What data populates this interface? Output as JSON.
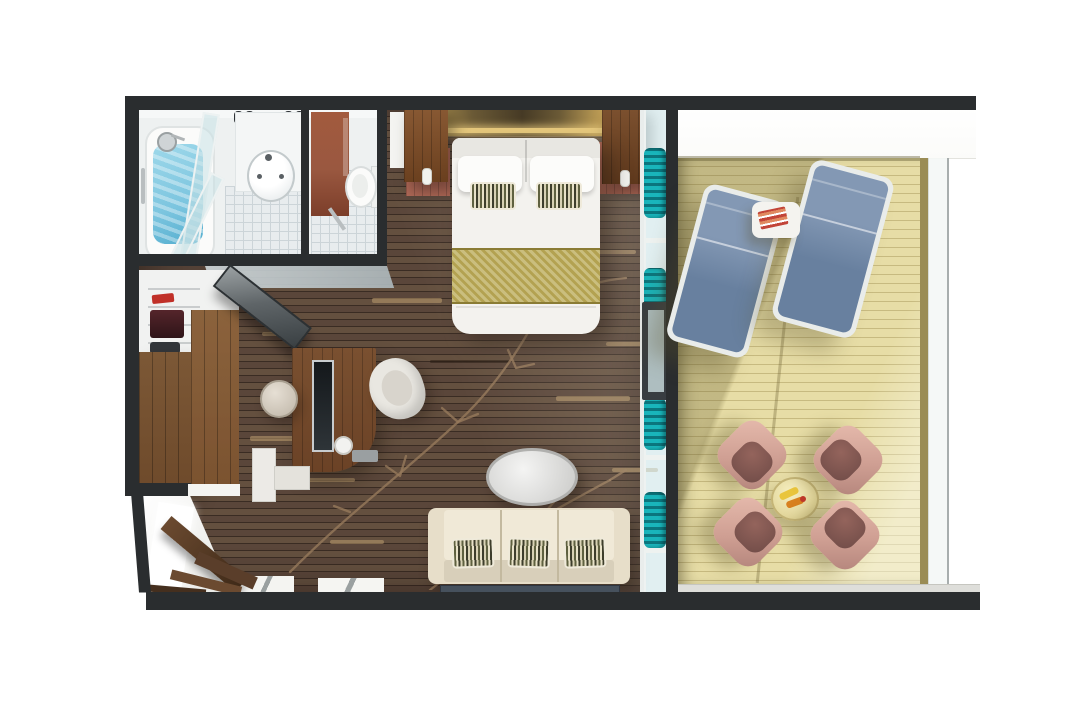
{
  "scene": {
    "kind": "3d-floorplan-render",
    "subject": "balcony-suite-stateroom",
    "rooms": [
      {
        "name": "bathroom",
        "items": [
          "bathtub-shower",
          "shower-head",
          "grab-bar",
          "glass-partition",
          "ceiling-spotlights",
          "vanity-sink",
          "toilet",
          "accent-wall",
          "tile-floor"
        ]
      },
      {
        "name": "wardrobe",
        "items": [
          "open-shelves",
          "hanging-clothes",
          "wood-cabinet",
          "wall-tv-panel"
        ]
      },
      {
        "name": "bedroom-living",
        "items": [
          "double-bed",
          "pillows",
          "striped-accent-pillows",
          "bed-runner",
          "headboard-light-strip",
          "pendant-wood-panels",
          "nightstand-left",
          "nightstand-right",
          "vanity-desk",
          "desk-mirror",
          "desk-chair",
          "stool",
          "drawer-unit",
          "sofa",
          "sofa-striped-pillows",
          "rug",
          "oval-coffee-table",
          "entry-door",
          "floor-vine-inlay"
        ]
      },
      {
        "name": "balcony",
        "items": [
          "glass-door",
          "teal-curtains",
          "sun-lounger-left",
          "sun-lounger-right",
          "side-table",
          "book",
          "round-table",
          "drink-yellow",
          "drink-orange",
          "shell-armchairs",
          "glass-railing",
          "wood-deck",
          "overhang"
        ]
      }
    ]
  },
  "palette": {
    "wall": "#2a2d2f",
    "floor-base": "#5a463a",
    "floor-line": "#3a2c23",
    "vine": "#96795b",
    "deck": "#e7dda6",
    "deck-line": "#c7ba80",
    "deck-shadow": "rgba(100,90,45,0.28)",
    "teal": "#19b5bb",
    "teal-dark": "#0b767e",
    "lounger": "#68809f",
    "lounger-light": "#8398b4",
    "chair": "#cf9f93",
    "chair-dark": "#6f4b47",
    "sofa": "#e7dec9",
    "sofa-seat": "#f0e9d7",
    "runner": "#b3a251",
    "gold": "#e6c87c",
    "nightstand": "#b26a58",
    "wood-cab": "#6e4a2b",
    "wood-cab2": "#7c5836",
    "desk-wood": "#6b4226",
    "shower-blue": "#7cc5df",
    "wc-wall": "#9a5840",
    "rug": "#46515d",
    "tile": "#e8ecee",
    "tile-line": "#ccd4d8",
    "glass": "rgba(200,226,229,0.55)",
    "railing": "#9a8c55",
    "ledge": "#dededa",
    "overhang": "#fbfbf9"
  }
}
